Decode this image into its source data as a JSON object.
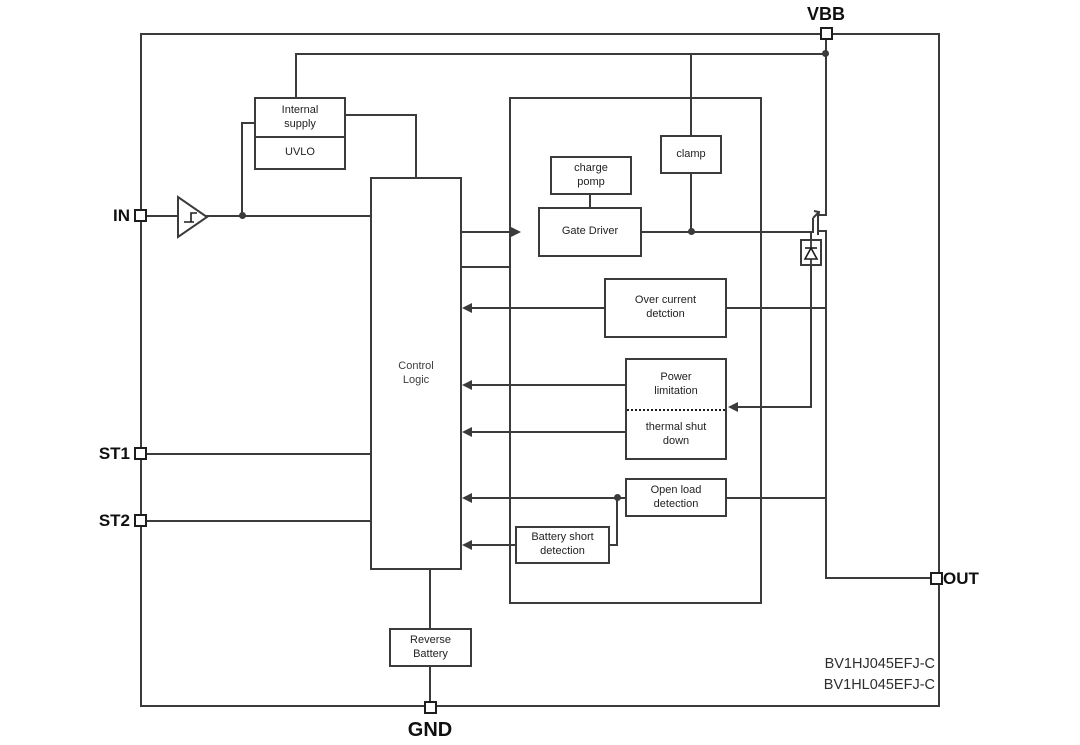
{
  "pins": {
    "vbb": "VBB",
    "in": "IN",
    "st1": "ST1",
    "st2": "ST2",
    "out": "OUT",
    "gnd": "GND"
  },
  "blocks": {
    "internal_supply": "Internal supply",
    "uvlo": "UVLO",
    "control_logic": "Control Logic",
    "charge_pomp": "charge pomp",
    "gate_driver": "Gate Driver",
    "clamp": "clamp",
    "over_current": "Over current detction",
    "power_limitation": "Power limitation",
    "thermal_shutdown": "thermal shut down",
    "open_load": "Open load detection",
    "battery_short": "Battery short detection",
    "reverse_battery": "Reverse Battery"
  },
  "part_numbers": [
    "BV1HJ045EFJ-C",
    "BV1HL045EFJ-C"
  ],
  "symbols": {
    "buffer": "schmitt-trigger-buffer",
    "mosfet": "power-mosfet",
    "diode": "temperature-sense-diode"
  },
  "colors": {
    "line": "#3b3b3b",
    "text": "#222222",
    "background": "#ffffff"
  }
}
